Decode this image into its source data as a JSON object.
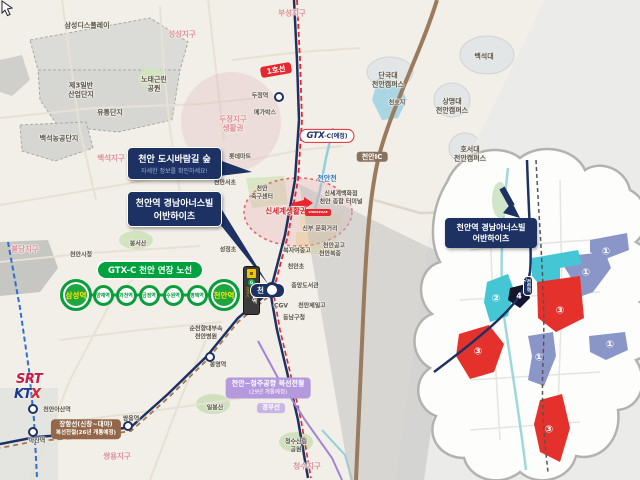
{
  "colors": {
    "navy": "#1d3263",
    "green": "#0a9d3c",
    "red_line": "#e8262d",
    "teal_parcel": "#45c6d4",
    "blue_parcel": "#8b96c8",
    "red_parcel": "#e5312b",
    "purple": "#b49add",
    "brown": "#93684a"
  },
  "labels": [
    {
      "t": "삼성디스플레이",
      "x": 87,
      "y": 26
    },
    {
      "t": "성성지구",
      "x": 182,
      "y": 34,
      "c": "p"
    },
    {
      "t": "부성지구",
      "x": 292,
      "y": 13,
      "c": "p"
    },
    {
      "t": "제3일반\n산업단지",
      "x": 81,
      "y": 90
    },
    {
      "t": "노태근린\n공원",
      "x": 154,
      "y": 84
    },
    {
      "t": "유통단지",
      "x": 110,
      "y": 113
    },
    {
      "t": "백석농공단지",
      "x": 59,
      "y": 139
    },
    {
      "t": "백석지구",
      "x": 111,
      "y": 158,
      "c": "p"
    },
    {
      "t": "두정역",
      "x": 260,
      "y": 96,
      "c": "s"
    },
    {
      "t": "메가박스",
      "x": 265,
      "y": 113,
      "c": "s"
    },
    {
      "t": "두정지구\n생활권",
      "x": 233,
      "y": 124,
      "c": "p"
    },
    {
      "t": "롯데마트",
      "x": 240,
      "y": 157,
      "c": "s"
    },
    {
      "t": "천안서초",
      "x": 225,
      "y": 183,
      "c": "s"
    },
    {
      "t": "백석대",
      "x": 484,
      "y": 57
    },
    {
      "t": "단국대\n천안캠퍼스",
      "x": 388,
      "y": 80
    },
    {
      "t": "천호지",
      "x": 397,
      "y": 103,
      "c": "s"
    },
    {
      "t": "상명대\n천안캠퍼스",
      "x": 452,
      "y": 106
    },
    {
      "t": "호서대\n천안캠퍼스",
      "x": 470,
      "y": 154
    },
    {
      "t": "천안천",
      "x": 327,
      "y": 179,
      "c": "b"
    },
    {
      "t": "신세계백화점\n천안 종합 터미널",
      "x": 341,
      "y": 198,
      "c": "s"
    },
    {
      "t": "신부 문화거리",
      "x": 320,
      "y": 229,
      "c": "s"
    },
    {
      "t": "천안\n축구센터",
      "x": 262,
      "y": 193,
      "c": "s"
    },
    {
      "t": "신세계생활권",
      "x": 286,
      "y": 211,
      "c": "r"
    },
    {
      "t": "천안공고",
      "x": 334,
      "y": 246,
      "c": "s"
    },
    {
      "t": "복자여중고",
      "x": 297,
      "y": 251,
      "c": "s"
    },
    {
      "t": "천안북중",
      "x": 330,
      "y": 254,
      "c": "s"
    },
    {
      "t": "천안초",
      "x": 296,
      "y": 267,
      "c": "s"
    },
    {
      "t": "중앙도서관",
      "x": 305,
      "y": 286,
      "c": "s"
    },
    {
      "t": "CGV",
      "x": 281,
      "y": 306,
      "c": "s"
    },
    {
      "t": "천안제일고",
      "x": 312,
      "y": 306,
      "c": "s"
    },
    {
      "t": "동남구청",
      "x": 294,
      "y": 318,
      "c": "s"
    },
    {
      "t": "성정초",
      "x": 228,
      "y": 250,
      "c": "s"
    },
    {
      "t": "봉서산",
      "x": 138,
      "y": 244,
      "c": "s"
    },
    {
      "t": "천안시청",
      "x": 81,
      "y": 255,
      "c": "s"
    },
    {
      "t": "불당지구",
      "x": 25,
      "y": 249,
      "c": "p"
    },
    {
      "t": "순천향대부속\n천안병원",
      "x": 206,
      "y": 333,
      "c": "s"
    },
    {
      "t": "봉명역",
      "x": 218,
      "y": 365,
      "c": "s"
    },
    {
      "t": "일봉산",
      "x": 215,
      "y": 408,
      "c": "s"
    },
    {
      "t": "쌍용역",
      "x": 131,
      "y": 419,
      "c": "s"
    },
    {
      "t": "쌍용지구",
      "x": 117,
      "y": 456,
      "c": "p"
    },
    {
      "t": "청수산림\n공원",
      "x": 296,
      "y": 446,
      "c": "s"
    },
    {
      "t": "청수지구",
      "x": 307,
      "y": 466,
      "c": "p"
    },
    {
      "t": "아산역",
      "x": 37,
      "y": 441,
      "c": "s"
    },
    {
      "t": "천안아산역",
      "x": 57,
      "y": 410,
      "c": "s"
    }
  ],
  "badges": {
    "line1": "1호선",
    "cheonan_ic": "천안IC",
    "gtx_logo": "GTX",
    "gtx_rest": "-C(예정)",
    "gyeongbu": "경부선",
    "cheongju_l1": "천안~청주공항 복선전철",
    "cheongju_l2": "(29년 개통예정)",
    "janghang_l1": "장항선(신창~대야)",
    "janghang_l2": "복선전철(26년 개통예정)"
  },
  "gtx": {
    "header": "GTX-C 천안 연장 노선",
    "stations": [
      {
        "n": "삼성역",
        "x": 76,
        "major": true
      },
      {
        "n": "양재역",
        "x": 103
      },
      {
        "n": "과천역",
        "x": 126
      },
      {
        "n": "금정역",
        "x": 149
      },
      {
        "n": "수원역",
        "x": 173
      },
      {
        "n": "평택역",
        "x": 197
      },
      {
        "n": "천안역",
        "x": 224,
        "major": true
      }
    ]
  },
  "signpost": {
    "icon": "rail",
    "gtx": "GTX-C",
    "name": "천안역"
  },
  "main_station": {
    "name": "천안역"
  },
  "callouts": {
    "forest": {
      "title": "천안 도시바람길 숲",
      "sub": "자세한 정보를 확인하세요!"
    },
    "apt": {
      "l1": "천안역 경남아너스빌",
      "l2": "어반하이츠"
    }
  },
  "cloud": {
    "label_l1": "천안역 경남아너스빌",
    "label_l2": "어반하이츠",
    "station": "천안역",
    "parcels": [
      {
        "num": "①",
        "x": 606,
        "y": 252
      },
      {
        "num": "①",
        "x": 586,
        "y": 273
      },
      {
        "num": "①",
        "x": 610,
        "y": 345
      },
      {
        "num": "①",
        "x": 539,
        "y": 358
      },
      {
        "num": "②",
        "x": 523,
        "y": 280
      },
      {
        "num": "②",
        "x": 496,
        "y": 299
      },
      {
        "num": "③",
        "x": 560,
        "y": 311
      },
      {
        "num": "③",
        "x": 478,
        "y": 352
      },
      {
        "num": "③",
        "x": 549,
        "y": 430
      },
      {
        "num": "4",
        "x": 519,
        "y": 296,
        "four": true
      }
    ]
  },
  "logos": {
    "srt": "SRT",
    "ktx_kt": "KT",
    "ktx_x": "X",
    "shinsegae": "SHINSEGAE"
  }
}
